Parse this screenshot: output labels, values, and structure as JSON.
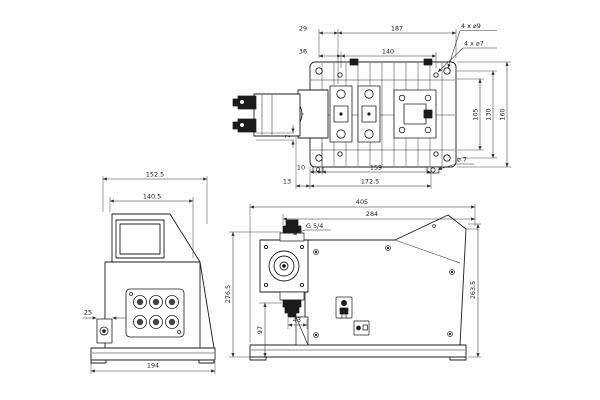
{
  "colors": {
    "background": "#ffffff",
    "ink": "#1b1b1b",
    "dim": "#2e2e2e"
  },
  "dims": {
    "top": {
      "offset29": "29",
      "span187": "187",
      "offset36": "36",
      "span140": "140",
      "holes9": "4 x ⌀9",
      "holes7": "4 x ⌀7",
      "h105": "105",
      "h130": "130",
      "h160": "160",
      "v7": "7",
      "off10": "10",
      "off13": "13",
      "span159": "159",
      "span172": "172.5",
      "dia7": "⌀ 7"
    },
    "front": {
      "w152": "152.5",
      "w140": "140.5",
      "off25": "25",
      "w194": "194"
    },
    "side": {
      "d405": "405",
      "d284": "284",
      "thread": "G 5/4",
      "h276": "276.5",
      "h97": "97",
      "off43": "43",
      "h263": "263.5"
    }
  }
}
